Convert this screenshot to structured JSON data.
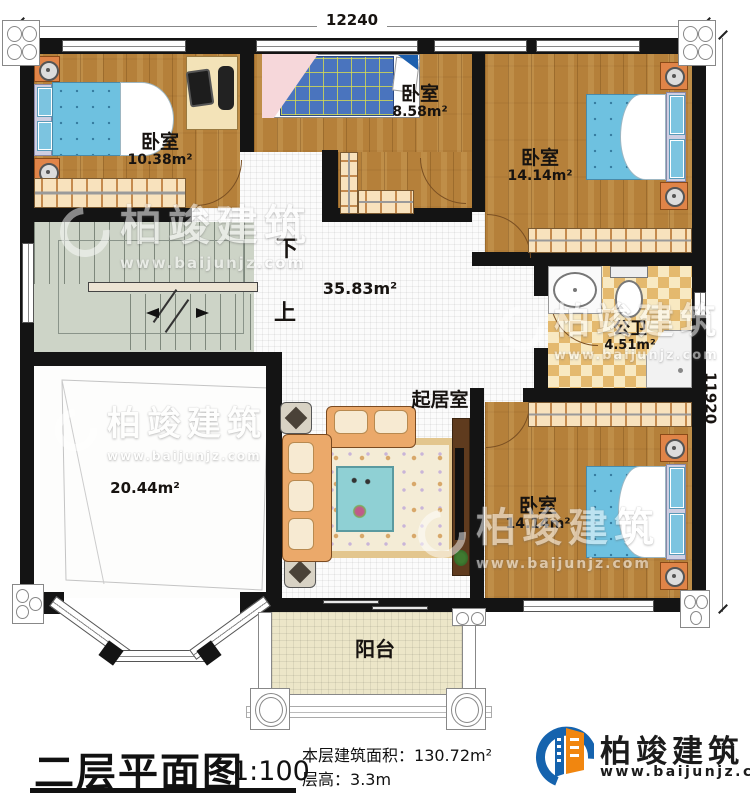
{
  "dimensions": {
    "top": "12240",
    "right": "11920"
  },
  "rooms": {
    "bedroom_tl": {
      "name": "卧室",
      "area": "10.38m²"
    },
    "bedroom_tm": {
      "name": "卧室",
      "area": "8.58m²"
    },
    "bedroom_tr": {
      "name": "卧室",
      "area": "14.14m²"
    },
    "bedroom_br": {
      "name": "卧室",
      "area": "14.14m²"
    },
    "bathroom": {
      "name": "公卫",
      "area": "4.51m²"
    },
    "hall": {
      "area": "35.83m²"
    },
    "void_room": {
      "area": "20.44m²"
    },
    "living": {
      "name": "起居室"
    },
    "balcony": {
      "name": "阳台"
    }
  },
  "stairs": {
    "down": "下",
    "up": "上"
  },
  "title": {
    "name": "二层平面图",
    "scale": "1:100",
    "floor_area_label": "本层建筑面积：",
    "floor_area_value": "130.72m²",
    "floor_height_label": "层高：",
    "floor_height_value": "3.3m"
  },
  "brand": {
    "name": "柏竣建筑",
    "url": "www.baijunjz.com"
  },
  "watermark": {
    "name": "柏竣建筑",
    "url": "www.baijunjz.com"
  },
  "colors": {
    "wall": "#141414",
    "wood": "#b5803a",
    "accent_blue": "#1563ae",
    "accent_orange": "#f1860f",
    "bed_blue": "#6ec1e0"
  }
}
